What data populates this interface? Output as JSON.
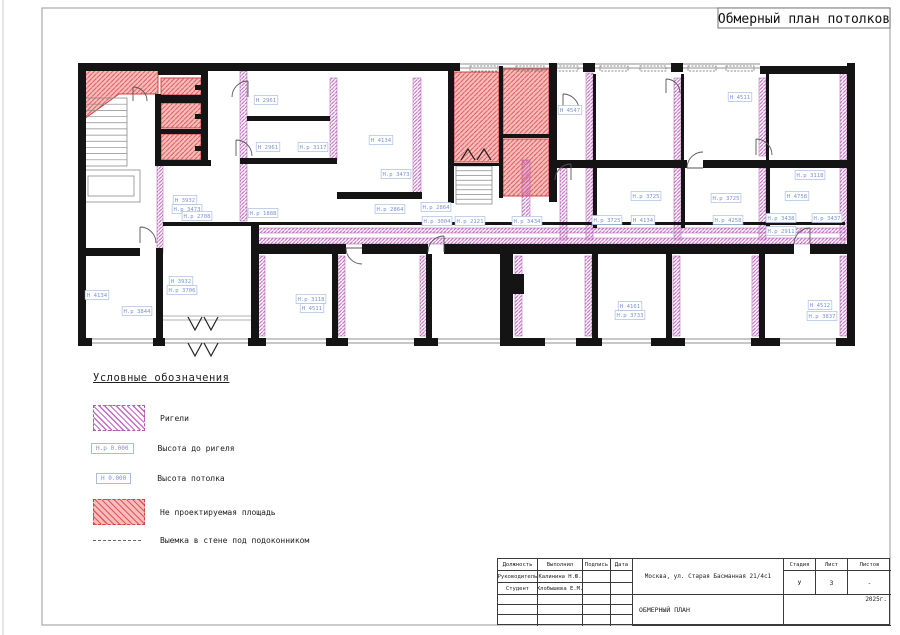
{
  "page": {
    "title": "Обмерный план потолков"
  },
  "colors": {
    "beam_hatch": "#c46ac4",
    "pink_area": "#f7bcbc",
    "pink_hatch": "#dd5858",
    "label_blue": "#7b93cf",
    "wall": "#141414"
  },
  "legend": {
    "title": "Условные обозначения",
    "items": [
      {
        "label": "Ригели"
      },
      {
        "box": "Н.р 0.000",
        "label": "Высота до ригеля"
      },
      {
        "box": "Н 0.000",
        "label": "Высота потолка"
      },
      {
        "label": "Не проектируемая площадь"
      },
      {
        "label": "Выемка в стене под подоконником"
      }
    ]
  },
  "titleblock": {
    "col_headers": [
      "Должность",
      "Выполнил",
      "Подпись",
      "Дата"
    ],
    "row1": [
      "Руководитель",
      "Калинина Н.Ю."
    ],
    "row2": [
      "Студент",
      "Хлобышева Е.М."
    ],
    "address": "Москва, ул. Старая Басманная 21/4с1",
    "stage_headers": [
      "Стадия",
      "Лист",
      "Листов"
    ],
    "stage_values": [
      "У",
      "3",
      "-"
    ],
    "doc_title": "ОБМЕРНЫЙ ПЛАН",
    "year": "2025г."
  },
  "plan": {
    "walls": [
      [
        78,
        63,
        382,
        8
      ],
      [
        760,
        66,
        95,
        8
      ],
      [
        78,
        63,
        8,
        283
      ],
      [
        847,
        63,
        8,
        283
      ],
      [
        583,
        63,
        12,
        9
      ],
      [
        671,
        63,
        12,
        9
      ],
      [
        78,
        338,
        14,
        8
      ],
      [
        153,
        338,
        12,
        8
      ],
      [
        248,
        338,
        18,
        8
      ],
      [
        326,
        338,
        22,
        8
      ],
      [
        414,
        338,
        24,
        8
      ],
      [
        500,
        338,
        45,
        8
      ],
      [
        576,
        338,
        26,
        8
      ],
      [
        651,
        338,
        34,
        8
      ],
      [
        751,
        338,
        29,
        8
      ],
      [
        836,
        338,
        19,
        8
      ],
      [
        158,
        66,
        49,
        9
      ],
      [
        155,
        95,
        52,
        8
      ],
      [
        155,
        129,
        52,
        5
      ],
      [
        155,
        160,
        56,
        6
      ],
      [
        155,
        94,
        6,
        72
      ],
      [
        201,
        66,
        7,
        100
      ],
      [
        195,
        85,
        7,
        5
      ],
      [
        195,
        114,
        7,
        5
      ],
      [
        195,
        146,
        7,
        5
      ],
      [
        247,
        116,
        83,
        5
      ],
      [
        240,
        158,
        97,
        6
      ],
      [
        337,
        192,
        85,
        7
      ],
      [
        448,
        63,
        6,
        140
      ],
      [
        499,
        66,
        4,
        132
      ],
      [
        503,
        134,
        46,
        4
      ],
      [
        549,
        63,
        8,
        105
      ],
      [
        549,
        160,
        8,
        42
      ],
      [
        557,
        160,
        130,
        8
      ],
      [
        703,
        160,
        144,
        8
      ],
      [
        593,
        168,
        4,
        60
      ],
      [
        681,
        168,
        4,
        60
      ],
      [
        766,
        168,
        4,
        60
      ],
      [
        593,
        74,
        3,
        86
      ],
      [
        681,
        74,
        3,
        86
      ],
      [
        766,
        74,
        3,
        86
      ],
      [
        255,
        244,
        91,
        10
      ],
      [
        362,
        244,
        66,
        10
      ],
      [
        444,
        244,
        350,
        10
      ],
      [
        810,
        244,
        37,
        10
      ],
      [
        255,
        222,
        590,
        3
      ],
      [
        163,
        222,
        92,
        4
      ],
      [
        251,
        222,
        8,
        116
      ],
      [
        78,
        248,
        62,
        8
      ],
      [
        156,
        248,
        7,
        90
      ],
      [
        332,
        254,
        6,
        84
      ],
      [
        426,
        254,
        6,
        84
      ],
      [
        500,
        254,
        13,
        84
      ],
      [
        513,
        274,
        11,
        20
      ],
      [
        592,
        254,
        6,
        84
      ],
      [
        666,
        254,
        6,
        84
      ],
      [
        759,
        254,
        6,
        84
      ],
      [
        452,
        163,
        48,
        3
      ]
    ],
    "purple": [
      [
        240,
        71,
        7,
        150
      ],
      [
        330,
        78,
        7,
        82
      ],
      [
        413,
        78,
        8,
        120
      ],
      [
        522,
        160,
        8,
        62
      ],
      [
        560,
        168,
        7,
        72
      ],
      [
        586,
        73,
        7,
        87
      ],
      [
        586,
        168,
        7,
        72
      ],
      [
        674,
        78,
        7,
        82
      ],
      [
        674,
        168,
        7,
        72
      ],
      [
        759,
        78,
        7,
        78
      ],
      [
        759,
        168,
        7,
        72
      ],
      [
        840,
        73,
        7,
        87
      ],
      [
        840,
        168,
        7,
        72
      ],
      [
        157,
        165,
        6,
        88
      ],
      [
        258,
        256,
        7,
        80
      ],
      [
        338,
        256,
        7,
        80
      ],
      [
        420,
        256,
        7,
        80
      ],
      [
        515,
        256,
        7,
        80
      ],
      [
        585,
        256,
        7,
        80
      ],
      [
        673,
        256,
        7,
        80
      ],
      [
        752,
        256,
        7,
        80
      ],
      [
        840,
        256,
        7,
        80
      ],
      [
        255,
        228,
        590,
        5
      ],
      [
        255,
        238,
        590,
        6
      ]
    ],
    "pink_polys": [
      "80,66 158,66 158,94 119,94 80,122"
    ],
    "pink_rects": [
      [
        161,
        78,
        40,
        17
      ],
      [
        161,
        103,
        40,
        25
      ],
      [
        161,
        134,
        40,
        26
      ],
      [
        454,
        72,
        45,
        90
      ],
      [
        503,
        69,
        46,
        66
      ],
      [
        503,
        139,
        46,
        57
      ]
    ],
    "windows": [
      [
        92,
        339,
        61
      ],
      [
        165,
        339,
        83
      ],
      [
        266,
        339,
        60
      ],
      [
        348,
        339,
        66
      ],
      [
        438,
        339,
        62
      ],
      [
        545,
        339,
        31
      ],
      [
        602,
        339,
        49
      ],
      [
        685,
        339,
        66
      ],
      [
        780,
        339,
        56
      ],
      [
        460,
        64,
        123
      ],
      [
        595,
        64,
        76
      ],
      [
        683,
        64,
        77
      ]
    ],
    "sills": [
      [
        470,
        66,
        28,
        5
      ],
      [
        516,
        66,
        28,
        5
      ],
      [
        556,
        66,
        22,
        5
      ],
      [
        600,
        66,
        28,
        5
      ],
      [
        640,
        66,
        26,
        5
      ],
      [
        688,
        66,
        28,
        5
      ],
      [
        726,
        66,
        28,
        5
      ],
      [
        770,
        67,
        30,
        5
      ],
      [
        812,
        67,
        30,
        5
      ]
    ],
    "gray_rects": [
      [
        82,
        98,
        45,
        68
      ],
      [
        82,
        170,
        58,
        32
      ],
      [
        88,
        176,
        46,
        20
      ],
      [
        456,
        166,
        36,
        38
      ]
    ],
    "stairs": [
      {
        "x": 82,
        "y": 98,
        "w": 45,
        "h": 68,
        "n": 11
      },
      {
        "x": 456,
        "y": 166,
        "w": 36,
        "h": 38,
        "n": 8
      }
    ],
    "glines": [
      [
        163,
        316,
        251,
        316
      ],
      [
        163,
        320,
        251,
        320
      ]
    ],
    "doors": [
      "M133,87 A14 14 0 0 1 147,101 M133,87 L133,101",
      "M248,81 A16 16 0 0 0 232,97 M248,81 L248,97",
      "M555,180 A16 16 0 0 1 571,164 M571,164 L571,180",
      "M563,94 A16 16 0 0 1 579,110 M563,94 L563,110",
      "M444,236 A16 16 0 0 0 428,252 M444,236 L444,252",
      "M346,248 A16 16 0 0 0 362,264 M346,248 L362,248",
      "M687,168 A16 16 0 0 1 703,152 M687,168 L703,168",
      "M140,227 A16 16 0 0 1 156,243 M140,227 L140,243",
      "M810,228 A16 16 0 0 0 794,244 M810,228 L810,244",
      "M666,79 A14 14 0 0 1 680,93 M666,79 L666,93",
      "M756,139 A16 16 0 0 1 772,155 M756,139 L756,155",
      "M236,140 A16 16 0 0 1 252,156 M236,140 L236,156"
    ],
    "chevrons": [
      "461,160 468,149 475,160",
      "477,160 484,149 491,160",
      "188,317 195,330 202,317",
      "204,317 211,330 218,317",
      "188,343 195,356 202,343",
      "204,343 211,356 218,343"
    ],
    "labels": [
      {
        "x": 266,
        "y": 100,
        "t": "Н 2961"
      },
      {
        "x": 268,
        "y": 147,
        "t": "Н 2961"
      },
      {
        "x": 313,
        "y": 147,
        "t": "Н.р 3117"
      },
      {
        "x": 381,
        "y": 140,
        "t": "Н 4134"
      },
      {
        "x": 396,
        "y": 174,
        "t": "Н.р 3473"
      },
      {
        "x": 185,
        "y": 200,
        "t": "Н 3932"
      },
      {
        "x": 187,
        "y": 209,
        "t": "Н.р 3473"
      },
      {
        "x": 197,
        "y": 216,
        "t": "Н.р 2708"
      },
      {
        "x": 263,
        "y": 213,
        "t": "Н.р 1888"
      },
      {
        "x": 390,
        "y": 209,
        "t": "Н.р 2864"
      },
      {
        "x": 436,
        "y": 207,
        "t": "Н.р 2864"
      },
      {
        "x": 437,
        "y": 221,
        "t": "Н.р 3004"
      },
      {
        "x": 470,
        "y": 221,
        "t": "Н.р 2121"
      },
      {
        "x": 527,
        "y": 221,
        "t": "Н.р 3434"
      },
      {
        "x": 570,
        "y": 110,
        "t": "Н 4547"
      },
      {
        "x": 740,
        "y": 97,
        "t": "Н 4511"
      },
      {
        "x": 646,
        "y": 196,
        "t": "Н.р 3725"
      },
      {
        "x": 607,
        "y": 220,
        "t": "Н.р 3725"
      },
      {
        "x": 643,
        "y": 220,
        "t": "Н 4134"
      },
      {
        "x": 726,
        "y": 198,
        "t": "Н.р 3725"
      },
      {
        "x": 728,
        "y": 220,
        "t": "Н.р 4258"
      },
      {
        "x": 810,
        "y": 175,
        "t": "Н.р 3118"
      },
      {
        "x": 797,
        "y": 196,
        "t": "Н 4758"
      },
      {
        "x": 781,
        "y": 218,
        "t": "Н.р 3438"
      },
      {
        "x": 827,
        "y": 218,
        "t": "Н.р 3437"
      },
      {
        "x": 781,
        "y": 231,
        "t": "Н.р 2911"
      },
      {
        "x": 97,
        "y": 295,
        "t": "Н 4134"
      },
      {
        "x": 137,
        "y": 311,
        "t": "Н.р 3844"
      },
      {
        "x": 181,
        "y": 281,
        "t": "Н 3932"
      },
      {
        "x": 182,
        "y": 290,
        "t": "Н.р 3706"
      },
      {
        "x": 311,
        "y": 299,
        "t": "Н.р 3118"
      },
      {
        "x": 312,
        "y": 308,
        "t": "Н 4511"
      },
      {
        "x": 630,
        "y": 306,
        "t": "Н 4161"
      },
      {
        "x": 630,
        "y": 315,
        "t": "Н.р 3733"
      },
      {
        "x": 820,
        "y": 305,
        "t": "Н 4512"
      },
      {
        "x": 822,
        "y": 316,
        "t": "Н.р 3837"
      }
    ]
  }
}
